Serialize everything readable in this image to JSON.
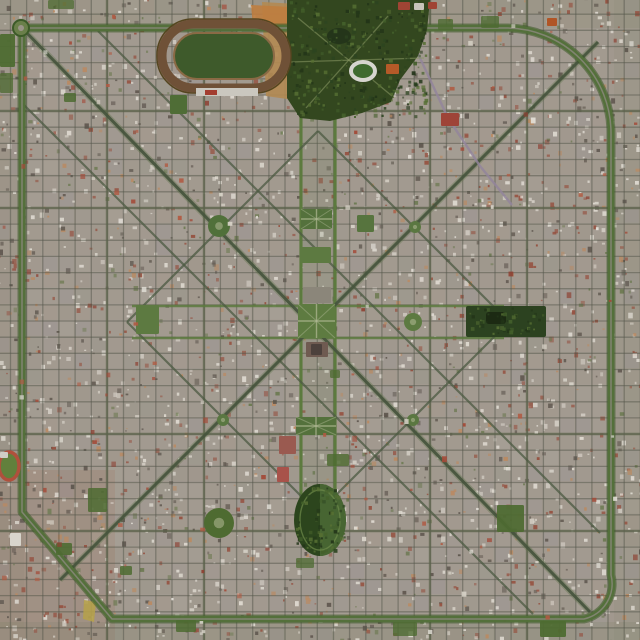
{
  "app": {
    "type": "satellite-aerial-photograph",
    "subject": "planned grid city with diagonal avenues, green ring road, central plaza, park and racetrack (La Plata style)"
  },
  "image": {
    "size": 640,
    "seed": 1337,
    "base_color": "#a29a90",
    "region_tints": [
      {
        "x": 0,
        "y": 470,
        "w": 115,
        "h": 170,
        "color": "rgba(150,95,70,0.16)"
      },
      {
        "x": 0,
        "y": 0,
        "w": 640,
        "h": 28,
        "color": "rgba(118,128,92,0.14)"
      },
      {
        "x": 614,
        "y": 0,
        "w": 26,
        "h": 640,
        "color": "rgba(122,130,98,0.13)"
      },
      {
        "x": 0,
        "y": 622,
        "w": 640,
        "h": 18,
        "color": "rgba(108,118,88,0.16)"
      },
      {
        "x": 0,
        "y": 28,
        "w": 24,
        "h": 600,
        "color": "rgba(130,120,100,0.12)"
      }
    ],
    "block_grid": {
      "step": 16.15,
      "phase_x": 10.5,
      "phase_y": 14.2,
      "tint_colors": [
        "#9d8f83",
        "#8f9183",
        "#b3ada3",
        "#97909b",
        "#a59a8c",
        "#a89588"
      ],
      "tint_opacity_min": 0.08,
      "tint_opacity_max": 0.22
    },
    "speckle": {
      "count": 2600,
      "min": 1.6,
      "max": 4.6,
      "colors": [
        [
          "#ded9d0",
          0.44
        ],
        [
          "#5f574f",
          0.2
        ],
        [
          "#95503f",
          0.18
        ],
        [
          "#b98a63",
          0.1
        ],
        [
          "#6d7a52",
          0.08
        ]
      ]
    },
    "streets": {
      "minor_color": "rgba(84,86,74,0.5)",
      "minor_width": 1.3,
      "lines": 40,
      "major_v": [
        107,
        204,
        430,
        527
      ],
      "major_h": [
        111,
        208,
        434,
        531
      ],
      "major_color": "rgba(92,100,76,0.7)",
      "major_width": 2.4,
      "axis_v": [
        301,
        335
      ],
      "axis_y1": 116,
      "axis_y2": 514,
      "axis_h": [
        306,
        338
      ],
      "axis_x1": 132,
      "axis_x2": 504,
      "axis_color": "#5c7a3e",
      "axis_width": 3.2,
      "axis_median": {
        "x": 303,
        "y": 118,
        "w": 30,
        "h": 394,
        "color": "rgba(106,126,88,0.16)"
      }
    },
    "diagonals": {
      "main_color": "#46543d",
      "main_width": 3.0,
      "main_under": "#5a7045",
      "main": [
        [
          24,
          30,
          590,
          612
        ],
        [
          598,
          42,
          60,
          580
        ]
      ],
      "secondary_color": "#4c5a42",
      "secondary_width": 2.2,
      "secondary": [
        [
          98,
          31,
          600,
          533
        ],
        [
          22,
          103,
          533,
          614
        ],
        [
          318,
          131,
          509,
          322
        ],
        [
          509,
          322,
          318,
          513
        ],
        [
          318,
          513,
          127,
          322
        ],
        [
          127,
          322,
          318,
          131
        ]
      ]
    },
    "railway": {
      "points": "392,0 420,58 448,118 480,166 512,205",
      "color": "#93859b",
      "width": 2.4
    },
    "ring": {
      "path": "M 29 28 H 506 A 105 105 0 0 1 611 133 V 575 A 36 36 0 0 1 584 619 L 112 619 L 22 512 V 36",
      "casing": "#3c5a28",
      "casing_w": 9,
      "color": "#53703a",
      "width": 6.5,
      "center": "#8d8a80",
      "center_w": 1.5,
      "roundabout": {
        "cx": 21,
        "cy": 28,
        "r": 8,
        "fill": "#6a7f4a",
        "hub": "#9a9488"
      }
    },
    "dirt_areas": [
      {
        "path": "M 262 2 L 298 4 L 294 100 L 266 96 Z",
        "color": "#b28a52",
        "op": 0.9
      },
      {
        "path": "M 251 5 L 291 7 L 289 28 L 253 26 Z",
        "color": "#bf7d3f",
        "op": 0.9
      },
      {
        "path": "M 84 600 L 96 602 L 94 622 L 83 619 Z",
        "color": "#b5a14b",
        "op": 0.9
      }
    ],
    "bosque_park": {
      "path": "M 287 0 L 430 0 L 427 30 L 418 56 L 400 80 L 391 102 L 362 113 L 330 121 L 300 118 L 287 98 Z",
      "color": "#33471f",
      "lake": {
        "cx": 339,
        "cy": 36,
        "rx": 12,
        "ry": 8,
        "color": "#24351a"
      },
      "trails": [
        [
          298,
          18,
          392,
          96
        ],
        [
          388,
          16,
          306,
          108
        ],
        [
          290,
          62,
          424,
          58
        ]
      ],
      "trail_color": "rgba(134,148,96,0.6)"
    },
    "east_park": {
      "x": 466,
      "y": 306,
      "w": 80,
      "h": 31,
      "color": "#2c4220",
      "pond": {
        "x": 486,
        "y": 312,
        "w": 20,
        "h": 12,
        "color": "#1c2a13"
      }
    },
    "oval_park": {
      "cx": 320,
      "cy": 520,
      "rx": 26,
      "ry": 36,
      "color": "#2c451d",
      "half_color": "rgba(80,112,58,0.75)",
      "ring": "#6d8a4a"
    },
    "park_speckle": {
      "colors": [
        "#223418",
        "#44602b",
        "#2c4420",
        "#566f33"
      ],
      "regions": [
        {
          "x": 288,
          "y": 1,
          "w": 140,
          "h": 119,
          "n": 330
        },
        {
          "x": 295,
          "y": 486,
          "w": 52,
          "h": 70,
          "n": 90
        },
        {
          "x": 467,
          "y": 307,
          "w": 78,
          "h": 29,
          "n": 60
        }
      ]
    },
    "racetrack": {
      "outer": {
        "x": 157,
        "y": 19,
        "w": 134,
        "h": 74,
        "rx": 36,
        "stroke": "#55451f",
        "w2": 1.5
      },
      "track": {
        "x": 162,
        "y": 24,
        "w": 124,
        "h": 64,
        "rx": 32,
        "stroke": "#6f5137",
        "w2": 9
      },
      "inner": {
        "x": 174,
        "y": 33,
        "w": 100,
        "h": 46,
        "rx": 23,
        "fill": "#3e5a2b",
        "stroke": "#8a6a45",
        "w2": 2
      },
      "stand": {
        "x": 196,
        "y": 88,
        "w": 62,
        "h": 8,
        "color": "#cac7bf"
      },
      "stand2": {
        "x": 205,
        "y": 90,
        "w": 12,
        "h": 5,
        "color": "#a33d30"
      }
    },
    "stadium": {
      "cx": 363,
      "cy": 71,
      "rx": 12,
      "ry": 9,
      "ring": "#d6d5cf",
      "rw": 4,
      "field": "#3f6a2f"
    },
    "mini_track": {
      "cx": 9,
      "cy": 466,
      "rx": 10,
      "ry": 14,
      "ring": "#b0503c",
      "rw": 3.5,
      "field": "#62803c"
    },
    "plazas": [
      {
        "type": "rect",
        "x": 298,
        "y": 304,
        "w": 37,
        "h": 34,
        "color": "#5e7b41",
        "name": "central-plaza",
        "paths": true
      },
      {
        "type": "rect",
        "x": 301,
        "y": 209,
        "w": 31,
        "h": 20,
        "color": "#54713c",
        "name": "plaza-north-2",
        "paths": true
      },
      {
        "type": "rect",
        "x": 300,
        "y": 247,
        "w": 31,
        "h": 16,
        "color": "#5d7a41",
        "name": "plaza-north-1"
      },
      {
        "type": "rect",
        "x": 296,
        "y": 417,
        "w": 40,
        "h": 18,
        "color": "#54713c",
        "name": "plaza-south",
        "paths": true
      },
      {
        "type": "rect",
        "x": 136,
        "y": 305,
        "w": 23,
        "h": 29,
        "color": "#5d7a41",
        "name": "plaza-west"
      },
      {
        "type": "circle",
        "cx": 413,
        "cy": 322,
        "r": 9,
        "color": "#5d7a41",
        "name": "plaza-east-circle"
      },
      {
        "type": "rect",
        "x": 357,
        "y": 215,
        "w": 17,
        "h": 17,
        "color": "#57743e",
        "name": "plaza-northeast"
      },
      {
        "type": "circle",
        "cx": 219,
        "cy": 226,
        "r": 11,
        "color": "#50703a",
        "name": "plaza-northwest-round"
      },
      {
        "type": "circle",
        "cx": 219,
        "cy": 523,
        "r": 15,
        "color": "#4e6b31",
        "name": "park-southwest-round"
      },
      {
        "type": "circle",
        "cx": 415,
        "cy": 227,
        "r": 6,
        "color": "#5a7741",
        "name": "plaza-small-1"
      },
      {
        "type": "circle",
        "cx": 223,
        "cy": 420,
        "r": 6,
        "color": "#5a7741",
        "name": "plaza-small-2"
      },
      {
        "type": "circle",
        "cx": 413,
        "cy": 420,
        "r": 6,
        "color": "#5a7741",
        "name": "plaza-small-3"
      },
      {
        "type": "rect",
        "x": 170,
        "y": 95,
        "w": 17,
        "h": 19,
        "color": "#4f6d36",
        "name": "plaza-nw-block"
      }
    ],
    "green_blocks": [
      [
        88,
        488,
        19,
        24
      ],
      [
        497,
        505,
        27,
        27
      ],
      [
        481,
        16,
        18,
        12
      ],
      [
        438,
        19,
        15,
        11
      ],
      [
        327,
        454,
        22,
        12
      ],
      [
        56,
        543,
        16,
        12
      ],
      [
        540,
        621,
        26,
        16
      ],
      [
        393,
        622,
        24,
        14
      ],
      [
        296,
        558,
        18,
        10
      ],
      [
        120,
        566,
        12,
        9
      ],
      [
        64,
        93,
        12,
        9
      ],
      [
        0,
        34,
        15,
        33
      ],
      [
        48,
        0,
        26,
        9
      ],
      [
        0,
        73,
        13,
        20
      ],
      [
        176,
        620,
        20,
        12
      ],
      [
        330,
        370,
        10,
        8
      ]
    ],
    "green_block_color": "#4e6b31",
    "buildings": [
      [
        441,
        113,
        18,
        13,
        "#9e4438"
      ],
      [
        386,
        64,
        13,
        10,
        "#b55a28"
      ],
      [
        547,
        18,
        10,
        8,
        "#b05526"
      ],
      [
        398,
        2,
        12,
        8,
        "#a04434"
      ],
      [
        414,
        3,
        10,
        7,
        "#c8c4ba"
      ],
      [
        428,
        2,
        9,
        7,
        "#a04434"
      ],
      [
        279,
        436,
        17,
        18,
        "#9a5a50"
      ],
      [
        277,
        467,
        12,
        15,
        "#a8524a"
      ],
      [
        10,
        533,
        11,
        13,
        "#d8d5cc"
      ],
      [
        306,
        342,
        22,
        15,
        "#6f5b51"
      ],
      [
        311,
        344,
        11,
        11,
        "#4c413c"
      ],
      [
        303,
        287,
        28,
        16,
        "#8b867a"
      ],
      [
        0,
        452,
        8,
        6,
        "#d0cdc5"
      ]
    ],
    "emphasis_speckle": {
      "count": 150,
      "min": 2.2,
      "max": 5.0,
      "colors": [
        "#a34a38",
        "#b05a42",
        "#8e4133",
        "#e3e0d8",
        "#d8d3c8"
      ],
      "avoid": [
        [
          287,
          0,
          143,
          121
        ],
        [
          292,
          484,
          56,
          73
        ],
        [
          466,
          306,
          80,
          31
        ],
        [
          157,
          19,
          134,
          74
        ]
      ]
    }
  }
}
